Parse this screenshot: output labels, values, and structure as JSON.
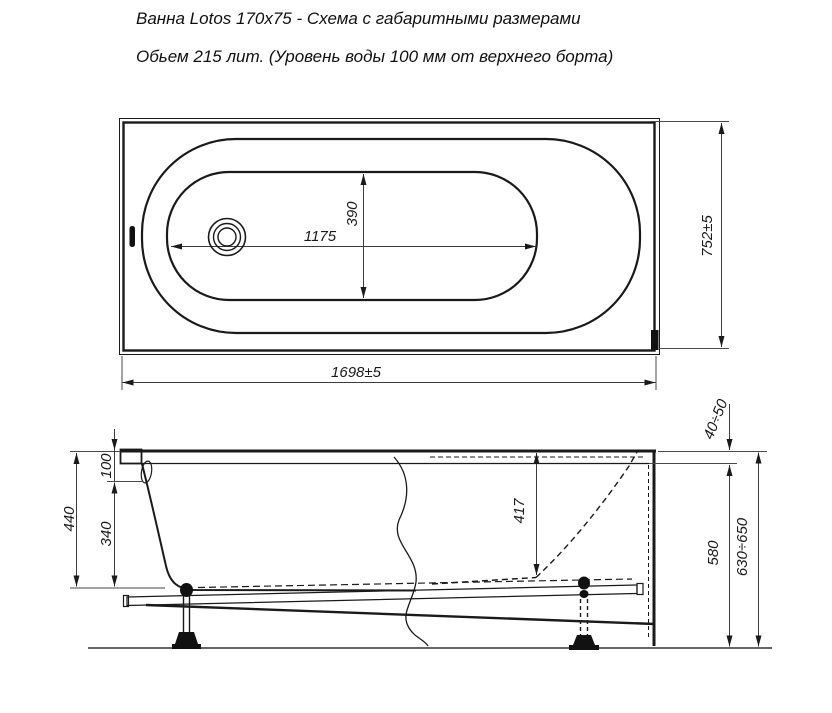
{
  "title": {
    "line1": "Ванна Lotos 170x75 - Схема с габаритными размерами",
    "line2": "Обьем 215 лит.  (Уровень воды 100 мм от верхнего борта)"
  },
  "plan_view": {
    "dims": {
      "bottom_length": "1175",
      "bottom_width": "390",
      "overall_length": "1698±5",
      "overall_width": "752±5"
    }
  },
  "side_view": {
    "dims": {
      "water_level_from_rim": "100",
      "water_depth": "340",
      "inner_depth_total": "440",
      "inner_depth_at_slope": "417",
      "height_under_rim": "580",
      "total_height_adjustable": "630÷650",
      "rim_band_height": "40÷50"
    }
  },
  "colors": {
    "line": "#1a1a1a",
    "dim_line": "#3c3c3c",
    "background": "#ffffff"
  }
}
